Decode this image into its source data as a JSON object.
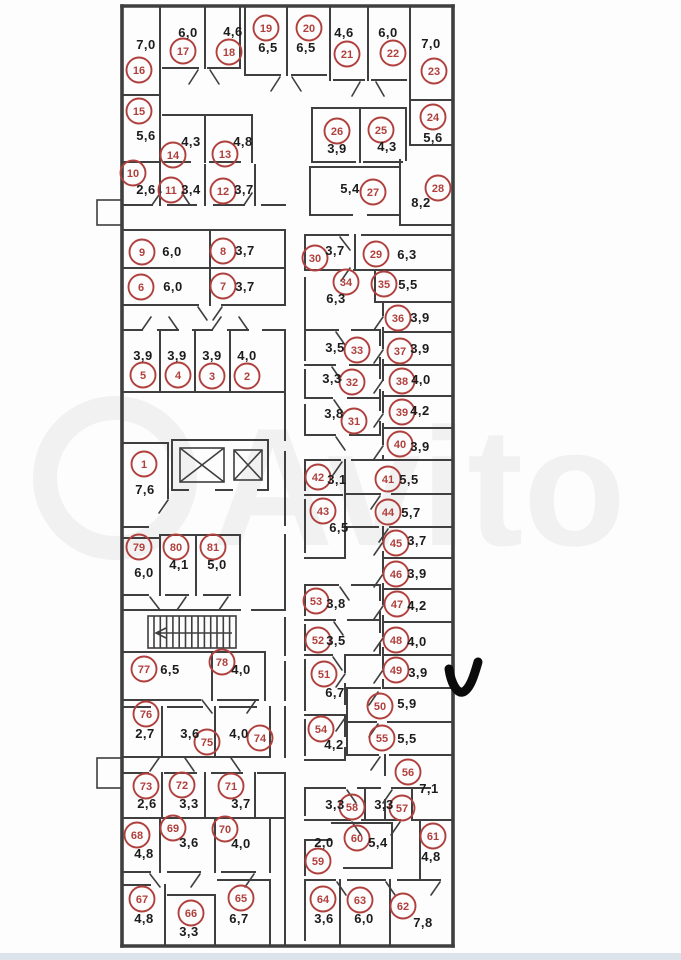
{
  "document": {
    "kind": "storage-units-floor-plan",
    "watermark_text": "Avito"
  },
  "style": {
    "unit_circle_color": "#b0403d",
    "wall_color": "#3f3f3f",
    "area_text_color": "#1c1c1c",
    "watermark_color": "#f2f1f2",
    "checkmark_color": "#0b0b0b",
    "bottom_strip_color": "#dde3ea",
    "background_color": "#fdfdfd"
  },
  "annotations": {
    "checkmark_present": true
  },
  "units": [
    {
      "n": "1",
      "area": "7,6",
      "cx": 144,
      "cy": 464,
      "ax": 145,
      "ay": 490
    },
    {
      "n": "2",
      "area": "4,0",
      "cx": 247,
      "cy": 376,
      "ax": 247,
      "ay": 356
    },
    {
      "n": "3",
      "area": "3,9",
      "cx": 212,
      "cy": 376,
      "ax": 212,
      "ay": 356
    },
    {
      "n": "4",
      "area": "3,9",
      "cx": 178,
      "cy": 375,
      "ax": 177,
      "ay": 356
    },
    {
      "n": "5",
      "area": "3,9",
      "cx": 143,
      "cy": 375,
      "ax": 143,
      "ay": 356
    },
    {
      "n": "6",
      "area": "6,0",
      "cx": 141,
      "cy": 287,
      "ax": 173,
      "ay": 287
    },
    {
      "n": "7",
      "area": "3,7",
      "cx": 223,
      "cy": 286,
      "ax": 245,
      "ay": 287
    },
    {
      "n": "8",
      "area": "3,7",
      "cx": 223,
      "cy": 251,
      "ax": 245,
      "ay": 251
    },
    {
      "n": "9",
      "area": "6,0",
      "cx": 142,
      "cy": 252,
      "ax": 172,
      "ay": 252
    },
    {
      "n": "10",
      "area": "2,6",
      "cx": 133,
      "cy": 173,
      "ax": 146,
      "ay": 190
    },
    {
      "n": "11",
      "area": "3,4",
      "cx": 171,
      "cy": 190,
      "ax": 191,
      "ay": 190
    },
    {
      "n": "12",
      "area": "3,7",
      "cx": 223,
      "cy": 191,
      "ax": 244,
      "ay": 190
    },
    {
      "n": "13",
      "area": "4,8",
      "cx": 225,
      "cy": 154,
      "ax": 243,
      "ay": 142
    },
    {
      "n": "14",
      "area": "4,3",
      "cx": 173,
      "cy": 155,
      "ax": 191,
      "ay": 142
    },
    {
      "n": "15",
      "area": "5,6",
      "cx": 139,
      "cy": 111,
      "ax": 146,
      "ay": 136
    },
    {
      "n": "16",
      "area": "7,0",
      "cx": 139,
      "cy": 70,
      "ax": 146,
      "ay": 45
    },
    {
      "n": "17",
      "area": "6,0",
      "cx": 183,
      "cy": 51,
      "ax": 188,
      "ay": 33
    },
    {
      "n": "18",
      "area": "4,6",
      "cx": 229,
      "cy": 52,
      "ax": 233,
      "ay": 32
    },
    {
      "n": "19",
      "area": "6,5",
      "cx": 266,
      "cy": 28,
      "ax": 268,
      "ay": 48
    },
    {
      "n": "20",
      "area": "6,5",
      "cx": 309,
      "cy": 28,
      "ax": 306,
      "ay": 48
    },
    {
      "n": "21",
      "area": "4,6",
      "cx": 347,
      "cy": 54,
      "ax": 344,
      "ay": 33
    },
    {
      "n": "22",
      "area": "6,0",
      "cx": 393,
      "cy": 53,
      "ax": 388,
      "ay": 33
    },
    {
      "n": "23",
      "area": "7,0",
      "cx": 434,
      "cy": 71,
      "ax": 431,
      "ay": 44
    },
    {
      "n": "24",
      "area": "5,6",
      "cx": 433,
      "cy": 117,
      "ax": 433,
      "ay": 138
    },
    {
      "n": "25",
      "area": "4,3",
      "cx": 381,
      "cy": 130,
      "ax": 387,
      "ay": 147
    },
    {
      "n": "26",
      "area": "3,9",
      "cx": 337,
      "cy": 131,
      "ax": 337,
      "ay": 149
    },
    {
      "n": "27",
      "area": "5,4",
      "cx": 373,
      "cy": 192,
      "ax": 350,
      "ay": 189
    },
    {
      "n": "28",
      "area": "8,2",
      "cx": 438,
      "cy": 188,
      "ax": 421,
      "ay": 203
    },
    {
      "n": "29",
      "area": "6,3",
      "cx": 376,
      "cy": 254,
      "ax": 407,
      "ay": 255
    },
    {
      "n": "30",
      "area": "3,7",
      "cx": 315,
      "cy": 258,
      "ax": 335,
      "ay": 251
    },
    {
      "n": "31",
      "area": "3,8",
      "cx": 354,
      "cy": 421,
      "ax": 334,
      "ay": 414
    },
    {
      "n": "32",
      "area": "3,3",
      "cx": 352,
      "cy": 382,
      "ax": 332,
      "ay": 379
    },
    {
      "n": "33",
      "area": "3,5",
      "cx": 357,
      "cy": 350,
      "ax": 335,
      "ay": 348
    },
    {
      "n": "34",
      "area": "6,3",
      "cx": 346,
      "cy": 282,
      "ax": 336,
      "ay": 299
    },
    {
      "n": "35",
      "area": "5,5",
      "cx": 384,
      "cy": 284,
      "ax": 408,
      "ay": 285
    },
    {
      "n": "36",
      "area": "3,9",
      "cx": 398,
      "cy": 318,
      "ax": 420,
      "ay": 318
    },
    {
      "n": "37",
      "area": "3,9",
      "cx": 400,
      "cy": 351,
      "ax": 420,
      "ay": 349
    },
    {
      "n": "38",
      "area": "4,0",
      "cx": 402,
      "cy": 381,
      "ax": 421,
      "ay": 380
    },
    {
      "n": "39",
      "area": "4,2",
      "cx": 402,
      "cy": 412,
      "ax": 420,
      "ay": 411
    },
    {
      "n": "40",
      "area": "3,9",
      "cx": 400,
      "cy": 444,
      "ax": 420,
      "ay": 447
    },
    {
      "n": "41",
      "area": "5,5",
      "cx": 388,
      "cy": 479,
      "ax": 409,
      "ay": 480
    },
    {
      "n": "42",
      "area": "3,1",
      "cx": 318,
      "cy": 477,
      "ax": 337,
      "ay": 480
    },
    {
      "n": "43",
      "area": "6,5",
      "cx": 323,
      "cy": 511,
      "ax": 339,
      "ay": 528
    },
    {
      "n": "44",
      "area": "5,7",
      "cx": 388,
      "cy": 512,
      "ax": 411,
      "ay": 513
    },
    {
      "n": "45",
      "area": "3,7",
      "cx": 396,
      "cy": 543,
      "ax": 417,
      "ay": 541
    },
    {
      "n": "46",
      "area": "3,9",
      "cx": 396,
      "cy": 574,
      "ax": 417,
      "ay": 574
    },
    {
      "n": "47",
      "area": "4,2",
      "cx": 397,
      "cy": 604,
      "ax": 417,
      "ay": 606
    },
    {
      "n": "48",
      "area": "4,0",
      "cx": 396,
      "cy": 640,
      "ax": 417,
      "ay": 642
    },
    {
      "n": "49",
      "area": "3,9",
      "cx": 396,
      "cy": 670,
      "ax": 418,
      "ay": 673
    },
    {
      "n": "50",
      "area": "5,9",
      "cx": 380,
      "cy": 706,
      "ax": 407,
      "ay": 704
    },
    {
      "n": "51",
      "area": "6,7",
      "cx": 324,
      "cy": 674,
      "ax": 335,
      "ay": 693
    },
    {
      "n": "52",
      "area": "3,5",
      "cx": 318,
      "cy": 640,
      "ax": 336,
      "ay": 641
    },
    {
      "n": "53",
      "area": "3,8",
      "cx": 316,
      "cy": 601,
      "ax": 336,
      "ay": 604
    },
    {
      "n": "54",
      "area": "4,2",
      "cx": 321,
      "cy": 729,
      "ax": 334,
      "ay": 745
    },
    {
      "n": "55",
      "area": "5,5",
      "cx": 382,
      "cy": 738,
      "ax": 407,
      "ay": 739
    },
    {
      "n": "56",
      "area": "7,1",
      "cx": 408,
      "cy": 772,
      "ax": 429,
      "ay": 789
    },
    {
      "n": "57",
      "area": "3,3",
      "cx": 402,
      "cy": 808,
      "ax": 384,
      "ay": 805
    },
    {
      "n": "58",
      "area": "3,3",
      "cx": 352,
      "cy": 807,
      "ax": 335,
      "ay": 805
    },
    {
      "n": "59",
      "area": "2,0",
      "cx": 318,
      "cy": 861,
      "ax": 324,
      "ay": 843
    },
    {
      "n": "60",
      "area": "5,4",
      "cx": 357,
      "cy": 838,
      "ax": 378,
      "ay": 843
    },
    {
      "n": "61",
      "area": "4,8",
      "cx": 433,
      "cy": 836,
      "ax": 431,
      "ay": 857
    },
    {
      "n": "62",
      "area": "7,8",
      "cx": 403,
      "cy": 906,
      "ax": 423,
      "ay": 923
    },
    {
      "n": "63",
      "area": "6,0",
      "cx": 360,
      "cy": 900,
      "ax": 364,
      "ay": 919
    },
    {
      "n": "64",
      "area": "3,6",
      "cx": 323,
      "cy": 899,
      "ax": 324,
      "ay": 919
    },
    {
      "n": "65",
      "area": "6,7",
      "cx": 241,
      "cy": 898,
      "ax": 239,
      "ay": 919
    },
    {
      "n": "66",
      "area": "3,3",
      "cx": 191,
      "cy": 913,
      "ax": 189,
      "ay": 932
    },
    {
      "n": "67",
      "area": "4,8",
      "cx": 142,
      "cy": 899,
      "ax": 144,
      "ay": 919
    },
    {
      "n": "68",
      "area": "4,8",
      "cx": 137,
      "cy": 835,
      "ax": 144,
      "ay": 854
    },
    {
      "n": "69",
      "area": "3,6",
      "cx": 173,
      "cy": 828,
      "ax": 189,
      "ay": 843
    },
    {
      "n": "70",
      "area": "4,0",
      "cx": 225,
      "cy": 829,
      "ax": 241,
      "ay": 844
    },
    {
      "n": "71",
      "area": "3,7",
      "cx": 231,
      "cy": 786,
      "ax": 241,
      "ay": 804
    },
    {
      "n": "72",
      "area": "3,3",
      "cx": 182,
      "cy": 785,
      "ax": 189,
      "ay": 804
    },
    {
      "n": "73",
      "area": "2,6",
      "cx": 146,
      "cy": 786,
      "ax": 147,
      "ay": 804
    },
    {
      "n": "74",
      "area": "4,0",
      "cx": 260,
      "cy": 738,
      "ax": 239,
      "ay": 734
    },
    {
      "n": "75",
      "area": "3,6",
      "cx": 207,
      "cy": 742,
      "ax": 190,
      "ay": 734
    },
    {
      "n": "76",
      "area": "2,7",
      "cx": 146,
      "cy": 714,
      "ax": 145,
      "ay": 734
    },
    {
      "n": "77",
      "area": "6,5",
      "cx": 144,
      "cy": 669,
      "ax": 170,
      "ay": 670
    },
    {
      "n": "78",
      "area": "4,0",
      "cx": 222,
      "cy": 662,
      "ax": 241,
      "ay": 670
    },
    {
      "n": "79",
      "area": "6,0",
      "cx": 139,
      "cy": 547,
      "ax": 144,
      "ay": 573
    },
    {
      "n": "80",
      "area": "4,1",
      "cx": 176,
      "cy": 547,
      "ax": 179,
      "ay": 565
    },
    {
      "n": "81",
      "area": "5,0",
      "cx": 213,
      "cy": 547,
      "ax": 217,
      "ay": 565
    }
  ]
}
